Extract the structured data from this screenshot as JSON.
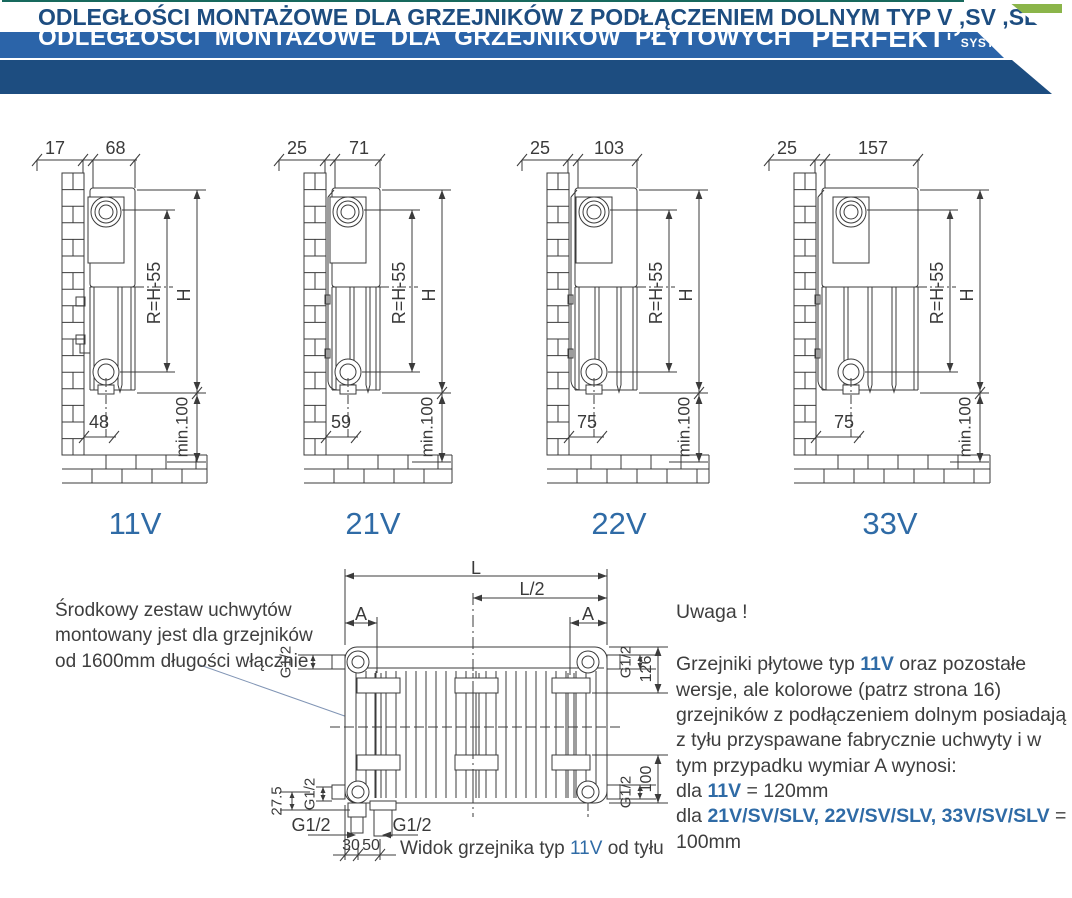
{
  "header": {
    "title": "ODLEGŁOŚCI  MONTAŻOWE  DLA GRZEJNIKÓW  PŁYTOWYCH",
    "brand": "PERFEKT",
    "brand_sub": "SYSTEM",
    "subtitle": "ODLEGŁOŚCI MONTAŻOWE DLA GRZEJNIKÓW Z PODŁĄCZENIEM DOLNYM TYP V ,SV ,SLV"
  },
  "colors": {
    "teal_strip": "#17695d",
    "green_strip": "#8bb54a",
    "banner_blue": "#2b64a9",
    "navy": "#1d4d80",
    "accent_blue": "#2f6ba6",
    "line": "#3b3b3b"
  },
  "side_views": [
    {
      "type_label": "11V",
      "wall_dim": "17",
      "depth_dim": "68",
      "r_dim": "R=H-55",
      "h_dim": "H",
      "min_dim": "min.100",
      "bottom_dim": "48"
    },
    {
      "type_label": "21V",
      "wall_dim": "25",
      "depth_dim": "71",
      "r_dim": "R=H-55",
      "h_dim": "H",
      "min_dim": "min.100",
      "bottom_dim": "59"
    },
    {
      "type_label": "22V",
      "wall_dim": "25",
      "depth_dim": "103",
      "r_dim": "R=H-55",
      "h_dim": "H",
      "min_dim": "min.100",
      "bottom_dim": "75"
    },
    {
      "type_label": "33V",
      "wall_dim": "25",
      "depth_dim": "157",
      "r_dim": "R=H-55",
      "h_dim": "H",
      "min_dim": "min.100",
      "bottom_dim": "75"
    }
  ],
  "rear_view": {
    "l": "L",
    "l_half": "L/2",
    "a": "A",
    "g_half": "G1/2",
    "d126": "126",
    "d100": "100",
    "d27_5": "27.5",
    "d30": "30",
    "d50": "50",
    "caption_pre": "Widok grzejnika typ ",
    "caption_type": "11V",
    "caption_post": " od tyłu"
  },
  "notes": {
    "left_note": "Środkowy zestaw uchwytów\nmontowany jest dla grzejników\nod 1600mm długości włącznie",
    "uwaga": "Uwaga !",
    "para_1": "Grzejniki płytowe typ ",
    "para_b": "11V",
    "para_2": " oraz pozostałe wersje, ale kolorowe (patrz strona 16) grzejników z podłączeniem dolnym posiadają z tyłu przyspawane fabrycznie uchwyty i w tym przypadku wymiar A wynosi:",
    "dla1_pre": "dla ",
    "dla1_b": "11V",
    "dla1_post": " = 120mm",
    "dla2_pre": "dla ",
    "dla2_b": "21V/SV/SLV, 22V/SV/SLV, 33V/SV/SLV",
    "dla2_post": " = 100mm"
  }
}
